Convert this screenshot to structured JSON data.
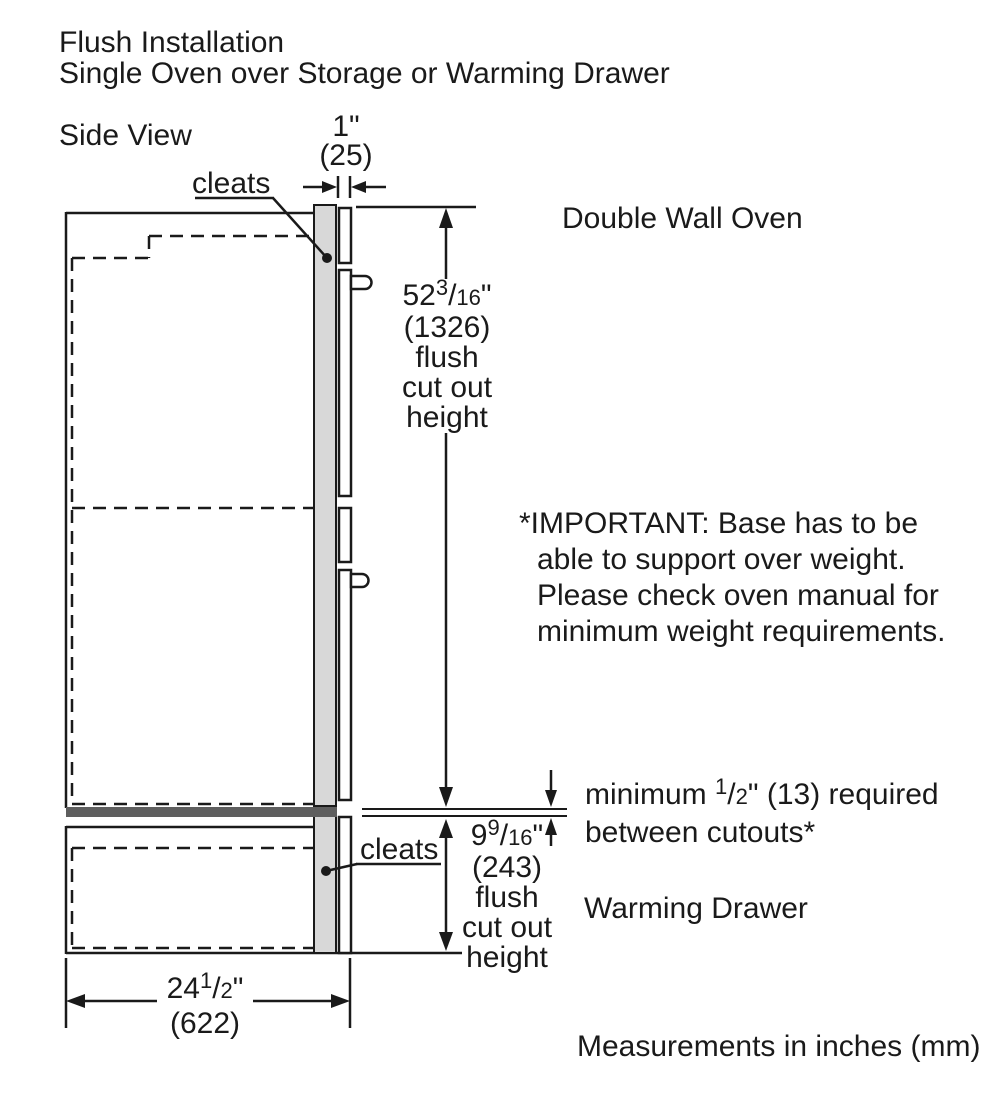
{
  "colors": {
    "line": "#1a1a1a",
    "cleat_fill": "#d8d8d8",
    "base_bar_fill": "#5e5e5e",
    "background": "#ffffff"
  },
  "header": {
    "line1": "Flush Installation",
    "line2": "Single Oven over Storage or Warming Drawer"
  },
  "view_label": "Side View",
  "labels": {
    "cleats_top": "cleats",
    "cleats_bottom": "cleats",
    "double_wall_oven": "Double Wall Oven",
    "warming_drawer": "Warming Drawer",
    "footer_note": "Measurements in inches (mm)"
  },
  "important_note": {
    "lines": [
      "*IMPORTANT: Base has to be",
      "able to support over weight.",
      "Please check oven manual for",
      "minimum weight requirements."
    ]
  },
  "dimensions": {
    "trim_overlap": {
      "inches": "1\"",
      "mm": "(25)"
    },
    "oven_cutout": {
      "whole": "52",
      "frac_sup": "3",
      "frac_slash": "/",
      "frac_den": "16",
      "unit_mark": "\"",
      "mm": "(1326)",
      "desc_lines": [
        "flush",
        "cut out",
        "height"
      ]
    },
    "min_gap": {
      "prefix": "minimum ",
      "frac_sup": "1",
      "frac_slash": "/",
      "frac_den": "2",
      "suffix": "\" (13) required",
      "line2": "between cutouts*"
    },
    "drawer_cutout": {
      "whole": "9",
      "frac_sup": "9",
      "frac_slash": "/",
      "frac_den": "16",
      "unit_mark": "\"",
      "mm": "(243)",
      "desc_lines": [
        "flush",
        "cut out",
        "height"
      ]
    },
    "cabinet_width": {
      "whole": "24",
      "frac_sup": "1",
      "frac_slash": "/",
      "frac_den": "2",
      "unit_mark": "\"",
      "mm": "(622)"
    }
  }
}
